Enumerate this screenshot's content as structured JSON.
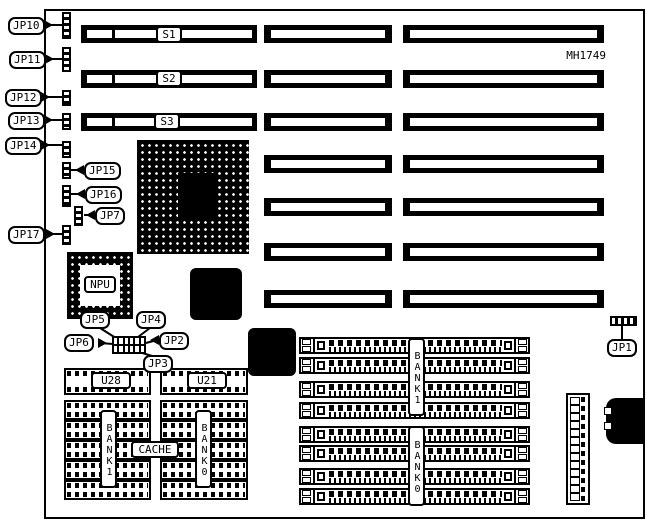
{
  "board": {
    "model": "MH1749",
    "ink": "#000000",
    "paper": "#ffffff"
  },
  "slots": [
    {
      "label": "S1"
    },
    {
      "label": "S2"
    },
    {
      "label": "S3"
    }
  ],
  "jumpers": {
    "jp1": "JP1",
    "jp2": "JP2",
    "jp3": "JP3",
    "jp4": "JP4",
    "jp5": "JP5",
    "jp6": "JP6",
    "jp7": "JP7",
    "jp10": "JP10",
    "jp11": "JP11",
    "jp12": "JP12",
    "jp13": "JP13",
    "jp14": "JP14",
    "jp15": "JP15",
    "jp16": "JP16",
    "jp17": "JP17"
  },
  "chips": {
    "npu": "NPU",
    "u28": "U28",
    "u21": "U21",
    "cache": "CACHE"
  },
  "memory": {
    "simm": {
      "top_bank": "BANK1",
      "bottom_bank": "BANK0"
    },
    "dip": {
      "left_bank": "BANK1",
      "right_bank": "BANK0"
    }
  }
}
